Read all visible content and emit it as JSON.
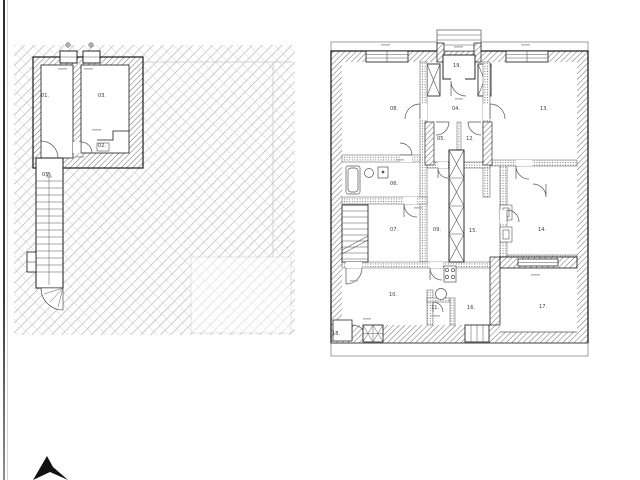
{
  "drawing": {
    "background": "#ffffff",
    "ink_color": "#1a1a1a",
    "hatch_color": "#adadad",
    "plans": [
      {
        "name": "left-plan",
        "description_rooms_visible": true,
        "rooms": [
          {
            "label": "01.",
            "x": 45,
            "y": 97
          },
          {
            "label": "03.",
            "x": 102,
            "y": 97
          },
          {
            "label": "02.",
            "x": 102,
            "y": 147
          },
          {
            "label": "05.",
            "x": 46,
            "y": 176
          }
        ]
      },
      {
        "name": "right-plan",
        "description_rooms_visible": true,
        "rooms": [
          {
            "label": "08.",
            "x": 394,
            "y": 110
          },
          {
            "label": "19.",
            "x": 457,
            "y": 67
          },
          {
            "label": "04.",
            "x": 456,
            "y": 110
          },
          {
            "label": "13.",
            "x": 544,
            "y": 110
          },
          {
            "label": "05.",
            "x": 441,
            "y": 140
          },
          {
            "label": "12.",
            "x": 470,
            "y": 140
          },
          {
            "label": "06.",
            "x": 394,
            "y": 185
          },
          {
            "label": "07.",
            "x": 394,
            "y": 231
          },
          {
            "label": "09.",
            "x": 437,
            "y": 231
          },
          {
            "label": "15.",
            "x": 473,
            "y": 232
          },
          {
            "label": "14.",
            "x": 542,
            "y": 231
          },
          {
            "label": "10.",
            "x": 393,
            "y": 296
          },
          {
            "label": "11.",
            "x": 435,
            "y": 309
          },
          {
            "label": "16.",
            "x": 471,
            "y": 309
          },
          {
            "label": "17.",
            "x": 543,
            "y": 308
          },
          {
            "label": "18.",
            "x": 336,
            "y": 335
          }
        ]
      }
    ],
    "north_arrow": {
      "present": true,
      "color": "#111111"
    },
    "scan_edge": {
      "present": true,
      "color": "#3a3a3a"
    }
  }
}
